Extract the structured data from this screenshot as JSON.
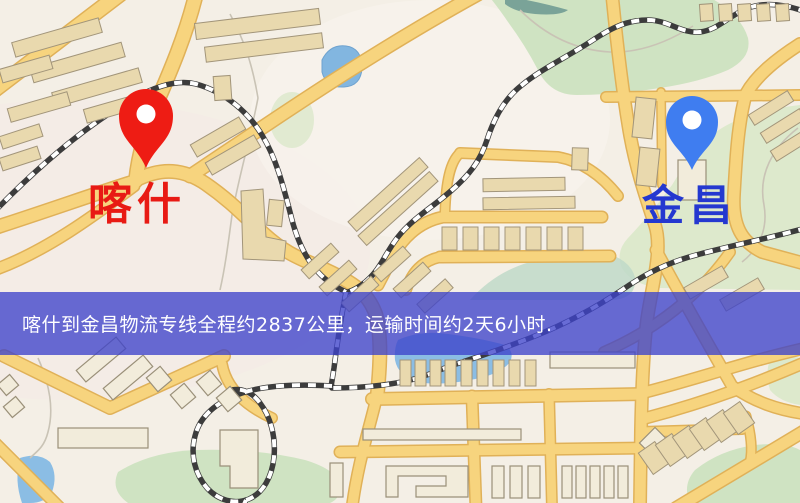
{
  "banner": {
    "text": "喀什到金昌物流专线全程约2837公里，运输时间约2天6小时.",
    "bg_color": "#3e42ca",
    "text_color": "#ffffff"
  },
  "markers": {
    "origin": {
      "label": "喀什",
      "pin_color": "#ee1c14",
      "label_color": "#e81a14",
      "icon": "map-pin-icon"
    },
    "destination": {
      "label": "金昌",
      "pin_color": "#3f7df0",
      "label_color": "#2438d0",
      "icon": "map-pin-icon"
    }
  },
  "map": {
    "background": "#f4efe6",
    "road_fill": "#f7d47e",
    "road_casing": "#e0b158",
    "park_color": "#cfe3c2",
    "water_color": "#8bbde4",
    "railway_color": "#3c3c3c",
    "building_color": "#e9d9ae"
  }
}
